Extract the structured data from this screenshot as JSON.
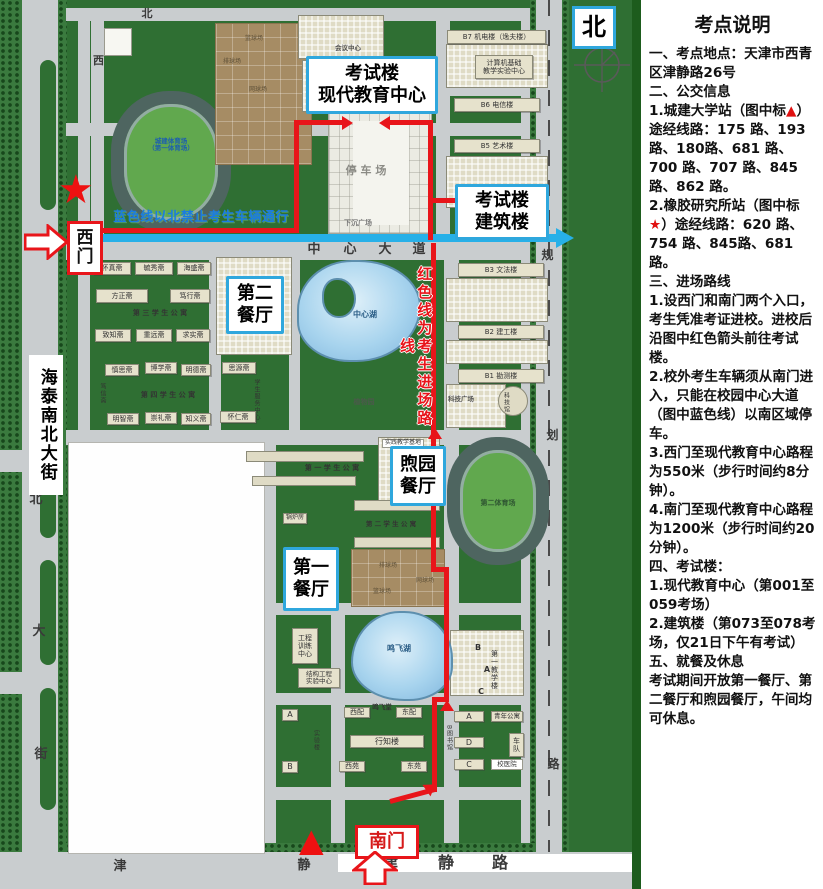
{
  "theme": {
    "marker_red": "#e01010",
    "route_red": "#e8151a",
    "route_blue": "#27b0e8",
    "callout_blue": "#2fa7dd",
    "campus_green": "#2f6f33"
  },
  "panel": {
    "title": "考点说明",
    "paragraphs": [
      [
        {
          "t": "一、考点地点：天津市西青区津静路26号"
        }
      ],
      [
        {
          "t": "二、公交信息"
        }
      ],
      [
        {
          "t": "1.城建大学站（图中标"
        },
        {
          "t": "▲",
          "c": 1
        },
        {
          "t": "）途经线路：175 路、193 路、180路、681 路、700 路、707 路、845 路、862 路。"
        }
      ],
      [
        {
          "t": "2.橡胶研究所站（图中标"
        },
        {
          "t": "★",
          "c": 1
        },
        {
          "t": "）途经线路：620 路、754 路、845路、681路。"
        }
      ],
      [
        {
          "t": "三、进场路线"
        }
      ],
      [
        {
          "t": "1.设西门和南门两个入口，考生凭准考证进校。进校后沿图中红色箭头前往考试楼。"
        }
      ],
      [
        {
          "t": "2.校外考生车辆须从南门进入，只能在校园中心大道（图中蓝色线）以南区域停车。"
        }
      ],
      [
        {
          "t": "3.西门至现代教育中心路程为550米（步行时间约8分钟）。"
        }
      ],
      [
        {
          "t": "4.南门至现代教育中心路程为1200米（步行时间约20分钟）。"
        }
      ],
      [
        {
          "t": "四、考试楼："
        }
      ],
      [
        {
          "t": "1.现代教育中心（第001至059考场）"
        }
      ],
      [
        {
          "t": "2.建筑楼（第073至078考场，"
        },
        {
          "t": "仅21日下午有考试",
          "b": 1
        },
        {
          "t": "）"
        }
      ],
      [
        {
          "t": "五、就餐及休息"
        }
      ],
      [
        {
          "t": "考试期间开放第一餐厅、第二餐厅和煦园餐厅，午间均可休息。"
        }
      ]
    ]
  },
  "map": {
    "markers": {
      "star": "★",
      "triangle": "▲"
    },
    "items": [
      {
        "id": "callout-exam-main",
        "cls": "callout",
        "lines": [
          "考试楼",
          "现代教育中心"
        ],
        "x": 306,
        "y": 56,
        "w": 126,
        "h": 52,
        "fs": 18
      },
      {
        "id": "callout-exam-arch",
        "cls": "callout",
        "lines": [
          "考试楼",
          "建筑楼"
        ],
        "x": 455,
        "y": 184,
        "w": 88,
        "h": 50,
        "fs": 18
      },
      {
        "id": "callout-canteen-2",
        "cls": "callout",
        "lines": [
          "第二",
          "餐厅"
        ],
        "x": 226,
        "y": 276,
        "w": 52,
        "h": 52,
        "fs": 18
      },
      {
        "id": "callout-canteen-xuyuan",
        "cls": "callout",
        "lines": [
          "煦园",
          "餐厅"
        ],
        "x": 390,
        "y": 446,
        "w": 50,
        "h": 54,
        "fs": 18
      },
      {
        "id": "callout-canteen-1",
        "cls": "callout",
        "lines": [
          "第一",
          "餐厅"
        ],
        "x": 283,
        "y": 547,
        "w": 50,
        "h": 58,
        "fs": 18
      },
      {
        "id": "label-west-gate",
        "cls": "gate",
        "lines": [
          "西",
          "门"
        ],
        "x": 67,
        "y": 221,
        "w": 30,
        "h": 48,
        "fs": 17
      },
      {
        "id": "label-south-gate",
        "cls": "gate",
        "t": "南门",
        "x": 355,
        "y": 825,
        "w": 58,
        "h": 28,
        "fs": 18,
        "color": "#d61a1a"
      },
      {
        "id": "label-north",
        "cls": "north",
        "t": "北",
        "x": 572,
        "y": 6,
        "w": 38,
        "h": 37,
        "fs": 24
      },
      {
        "id": "bldg-b7-jidian",
        "cls": "bar",
        "t": "B7 机电楼（逸夫楼）",
        "x": 447,
        "y": 30,
        "w": 99,
        "h": 14,
        "fs": 7
      },
      {
        "id": "bldg-computer-center",
        "cls": "bar",
        "lines": [
          "计算机基础",
          "教学实验中心"
        ],
        "x": 475,
        "y": 55,
        "w": 58,
        "h": 24,
        "fs": 7
      },
      {
        "id": "bldg-b6-dianxin",
        "cls": "bar",
        "t": "B6 电信楼",
        "x": 454,
        "y": 98,
        "w": 86,
        "h": 14,
        "fs": 7
      },
      {
        "id": "bldg-b5-yishu",
        "cls": "bar",
        "t": "B5 艺术楼",
        "x": 454,
        "y": 139,
        "w": 86,
        "h": 14,
        "fs": 7
      },
      {
        "id": "bldg-b3-wenfa",
        "cls": "bar",
        "t": "B3 文法楼",
        "x": 458,
        "y": 263,
        "w": 86,
        "h": 14,
        "fs": 7
      },
      {
        "id": "bldg-b2-jiangong",
        "cls": "bar",
        "t": "B2 建工楼",
        "x": 458,
        "y": 325,
        "w": 86,
        "h": 14,
        "fs": 7
      },
      {
        "id": "bldg-b1-kance",
        "cls": "bar",
        "t": "B1 勘测楼",
        "x": 458,
        "y": 369,
        "w": 86,
        "h": 14,
        "fs": 7
      },
      {
        "id": "label-science-plaza",
        "cls": "lbl",
        "t": "科技广场",
        "x": 444,
        "y": 395,
        "w": 34,
        "h": 9,
        "fs": 6.5,
        "color": "#555"
      },
      {
        "id": "label-science-museum",
        "cls": "vlbl",
        "t": "科技馆",
        "x": 500,
        "y": 387,
        "w": 10,
        "h": 30,
        "fs": 6
      },
      {
        "id": "dorm-huaizhen",
        "cls": "bar",
        "t": "怀真斋",
        "x": 93,
        "y": 262,
        "w": 38,
        "h": 13,
        "fs": 7
      },
      {
        "id": "dorm-yuxiu",
        "cls": "bar",
        "t": "毓秀斋",
        "x": 135,
        "y": 262,
        "w": 38,
        "h": 13,
        "fs": 7
      },
      {
        "id": "dorm-haisheng",
        "cls": "bar",
        "t": "海盛斋",
        "x": 177,
        "y": 262,
        "w": 34,
        "h": 13,
        "fs": 7
      },
      {
        "id": "dorm-fangzheng",
        "cls": "bar",
        "t": "方正斋",
        "x": 96,
        "y": 289,
        "w": 52,
        "h": 14,
        "fs": 7
      },
      {
        "id": "dorm-duxing",
        "cls": "bar",
        "t": "笃行斋",
        "x": 170,
        "y": 289,
        "w": 40,
        "h": 14,
        "fs": 7
      },
      {
        "id": "label-apartment-3",
        "cls": "lbl",
        "t": "第 三 学 生 公 寓",
        "x": 120,
        "y": 308,
        "w": 80,
        "h": 10,
        "fs": 7
      },
      {
        "id": "dorm-zhizhi",
        "cls": "bar",
        "t": "致知斋",
        "x": 95,
        "y": 329,
        "w": 36,
        "h": 13,
        "fs": 7
      },
      {
        "id": "dorm-zhongyuan",
        "cls": "bar",
        "t": "重远斋",
        "x": 136,
        "y": 329,
        "w": 36,
        "h": 13,
        "fs": 7
      },
      {
        "id": "dorm-qiushi",
        "cls": "bar",
        "t": "求实斋",
        "x": 176,
        "y": 329,
        "w": 34,
        "h": 13,
        "fs": 7
      },
      {
        "id": "dorm-shensi",
        "cls": "bar",
        "t": "慎思斋",
        "x": 105,
        "y": 364,
        "w": 34,
        "h": 12,
        "fs": 7
      },
      {
        "id": "dorm-boxue",
        "cls": "bar",
        "t": "博学斋",
        "x": 145,
        "y": 362,
        "w": 32,
        "h": 12,
        "fs": 7
      },
      {
        "id": "dorm-mingde",
        "cls": "bar",
        "t": "明德斋",
        "x": 181,
        "y": 364,
        "w": 30,
        "h": 12,
        "fs": 7
      },
      {
        "id": "dorm-siyuan",
        "cls": "bar",
        "t": "思源斋",
        "x": 222,
        "y": 362,
        "w": 34,
        "h": 12,
        "fs": 7
      },
      {
        "id": "dorm-duxin",
        "cls": "vlbl",
        "t": "笃信斋",
        "x": 96,
        "y": 378,
        "w": 11,
        "h": 30,
        "fs": 6
      },
      {
        "id": "label-apartment-4",
        "cls": "lbl",
        "t": "第 四 学 生 公 寓",
        "x": 128,
        "y": 390,
        "w": 80,
        "h": 10,
        "fs": 7
      },
      {
        "id": "label-student-service",
        "cls": "vlbl",
        "t": "学生服务中心",
        "x": 250,
        "y": 379,
        "w": 11,
        "h": 42,
        "fs": 6
      },
      {
        "id": "dorm-mingzhi",
        "cls": "bar",
        "t": "明智斋",
        "x": 107,
        "y": 413,
        "w": 32,
        "h": 12,
        "fs": 7
      },
      {
        "id": "dorm-chongli",
        "cls": "bar",
        "t": "崇礼斋",
        "x": 145,
        "y": 412,
        "w": 32,
        "h": 12,
        "fs": 7
      },
      {
        "id": "dorm-zhiyi",
        "cls": "bar",
        "t": "知义斋",
        "x": 181,
        "y": 413,
        "w": 30,
        "h": 12,
        "fs": 7
      },
      {
        "id": "dorm-huairen",
        "cls": "bar",
        "t": "怀仁斋",
        "x": 220,
        "y": 411,
        "w": 36,
        "h": 12,
        "fs": 7
      },
      {
        "id": "label-practice-base",
        "cls": "wlbl",
        "t": "实践教学基地",
        "x": 382,
        "y": 439,
        "w": 42,
        "h": 9,
        "fs": 6
      },
      {
        "id": "label-apartment-1",
        "cls": "lbl",
        "t": "第 一 学 生 公 寓",
        "x": 294,
        "y": 463,
        "w": 76,
        "h": 10,
        "fs": 7
      },
      {
        "id": "bldg-boiler",
        "cls": "bar",
        "t": "锅炉房",
        "x": 283,
        "y": 513,
        "w": 24,
        "h": 11,
        "fs": 6
      },
      {
        "id": "label-apartment-2",
        "cls": "lbl",
        "t": "第 二 学 生 公 寓",
        "x": 356,
        "y": 520,
        "w": 70,
        "h": 9,
        "fs": 6.5
      },
      {
        "id": "bldg-engineering-training",
        "cls": "bar",
        "lines": [
          "工程",
          "训练",
          "中心"
        ],
        "x": 292,
        "y": 628,
        "w": 26,
        "h": 36,
        "fs": 7
      },
      {
        "id": "bldg-structural-lab",
        "cls": "bar",
        "lines": [
          "结构工程",
          "实验中心"
        ],
        "x": 298,
        "y": 668,
        "w": 42,
        "h": 20,
        "fs": 6.5
      },
      {
        "id": "label-central-lake",
        "cls": "lbl",
        "t": "中心湖",
        "x": 350,
        "y": 310,
        "w": 30,
        "h": 10,
        "fs": 8,
        "color": "#2a5d86"
      },
      {
        "id": "label-botanical",
        "cls": "lbl",
        "t": "植物园",
        "x": 350,
        "y": 398,
        "w": 28,
        "h": 9,
        "fs": 7,
        "color": "#4a5a4a"
      },
      {
        "id": "label-mingfei-lake",
        "cls": "lbl",
        "t": "鸣飞湖",
        "x": 384,
        "y": 644,
        "w": 30,
        "h": 10,
        "fs": 8,
        "color": "#2a5d86"
      },
      {
        "id": "bldg-xipei",
        "cls": "bar",
        "t": "西配",
        "x": 344,
        "y": 707,
        "w": 26,
        "h": 11,
        "fs": 7
      },
      {
        "id": "label-mingfei-hall",
        "cls": "lbl",
        "t": "鸣飞堂",
        "x": 369,
        "y": 704,
        "w": 26,
        "h": 8,
        "fs": 6.5
      },
      {
        "id": "bldg-dongpei",
        "cls": "bar",
        "t": "东配",
        "x": 396,
        "y": 707,
        "w": 26,
        "h": 11,
        "fs": 7
      },
      {
        "id": "bldg-xingzhi",
        "cls": "bar",
        "t": "行知楼",
        "x": 350,
        "y": 735,
        "w": 74,
        "h": 13,
        "fs": 8
      },
      {
        "id": "bldg-xiyuan",
        "cls": "bar",
        "t": "西苑",
        "x": 339,
        "y": 761,
        "w": 26,
        "h": 11,
        "fs": 7
      },
      {
        "id": "bldg-dongyuan",
        "cls": "bar",
        "t": "东苑",
        "x": 401,
        "y": 761,
        "w": 26,
        "h": 11,
        "fs": 7
      },
      {
        "id": "bldg-block-a-west",
        "cls": "bar",
        "t": "A",
        "x": 282,
        "y": 709,
        "w": 16,
        "h": 12,
        "fs": 8
      },
      {
        "id": "bldg-block-b-west",
        "cls": "bar",
        "t": "B",
        "x": 282,
        "y": 761,
        "w": 16,
        "h": 12,
        "fs": 8
      },
      {
        "id": "label-lab-building",
        "cls": "vlbl",
        "t": "实验楼",
        "x": 310,
        "y": 726,
        "w": 10,
        "h": 28,
        "fs": 6
      },
      {
        "id": "label-first-teaching",
        "cls": "vlbl",
        "t": "第一教学楼",
        "x": 489,
        "y": 648,
        "w": 11,
        "h": 44,
        "fs": 7
      },
      {
        "id": "label-t1-b",
        "cls": "lbl",
        "t": "B",
        "x": 472,
        "y": 643,
        "w": 12,
        "h": 9,
        "fs": 8
      },
      {
        "id": "label-t1-a",
        "cls": "lbl",
        "t": "A",
        "x": 481,
        "y": 665,
        "w": 12,
        "h": 9,
        "fs": 8
      },
      {
        "id": "label-t1-c",
        "cls": "lbl",
        "t": "C",
        "x": 475,
        "y": 687,
        "w": 12,
        "h": 9,
        "fs": 8
      },
      {
        "id": "bldg-lib-a",
        "cls": "bar",
        "t": "A",
        "x": 454,
        "y": 711,
        "w": 30,
        "h": 11,
        "fs": 8
      },
      {
        "id": "bldg-lib-d",
        "cls": "bar",
        "t": "D",
        "x": 454,
        "y": 737,
        "w": 30,
        "h": 11,
        "fs": 8
      },
      {
        "id": "bldg-lib-c",
        "cls": "bar",
        "t": "C",
        "x": 454,
        "y": 759,
        "w": 30,
        "h": 11,
        "fs": 8
      },
      {
        "id": "label-library",
        "cls": "vlbl",
        "t": "B图书馆",
        "x": 443,
        "y": 718,
        "w": 10,
        "h": 40,
        "fs": 6
      },
      {
        "id": "bldg-youth-apartment",
        "cls": "bar",
        "t": "青年公寓",
        "x": 491,
        "y": 711,
        "w": 32,
        "h": 11,
        "fs": 6.5
      },
      {
        "id": "bldg-motorpool",
        "cls": "bar",
        "lines": [
          "车",
          "队"
        ],
        "x": 509,
        "y": 733,
        "w": 15,
        "h": 24,
        "fs": 7
      },
      {
        "id": "bldg-hospital",
        "cls": "wlbl",
        "t": "校医院",
        "x": 491,
        "y": 759,
        "w": 32,
        "h": 11,
        "fs": 6.5
      },
      {
        "id": "label-stadium-1",
        "cls": "lbl",
        "lines": [
          "城建体育场",
          "（第一体育场）"
        ],
        "x": 136,
        "y": 136,
        "w": 70,
        "h": 18,
        "fs": 6.5,
        "color": "#1d5fae"
      },
      {
        "id": "label-stadium-2",
        "cls": "lbl",
        "t": "第二体育场",
        "x": 462,
        "y": 498,
        "w": 72,
        "h": 10,
        "fs": 7,
        "color": "#2e5531"
      },
      {
        "id": "label-court-basketball-n",
        "cls": "court-lbl",
        "t": "篮球场",
        "x": 242,
        "y": 35,
        "w": 24,
        "h": 8,
        "fs": 6
      },
      {
        "id": "label-court-volleyball-n",
        "cls": "court-lbl",
        "t": "排球场",
        "x": 220,
        "y": 58,
        "w": 24,
        "h": 8,
        "fs": 6
      },
      {
        "id": "label-court-tennis-n",
        "cls": "court-lbl",
        "t": "网球场",
        "x": 246,
        "y": 86,
        "w": 24,
        "h": 8,
        "fs": 6
      },
      {
        "id": "label-court-volleyball-s",
        "cls": "court-lbl",
        "t": "排球场",
        "x": 376,
        "y": 562,
        "w": 24,
        "h": 8,
        "fs": 6
      },
      {
        "id": "label-court-tennis-s",
        "cls": "court-lbl",
        "t": "网球场",
        "x": 413,
        "y": 577,
        "w": 24,
        "h": 8,
        "fs": 6
      },
      {
        "id": "label-court-basketball-s",
        "cls": "court-lbl",
        "t": "篮球场",
        "x": 370,
        "y": 588,
        "w": 24,
        "h": 8,
        "fs": 6
      },
      {
        "id": "label-conference-center",
        "cls": "lbl",
        "t": "会议中心",
        "x": 330,
        "y": 44,
        "w": 36,
        "h": 9,
        "fs": 6.5,
        "color": "#555"
      },
      {
        "id": "label-parking",
        "cls": "lbl",
        "t": "停 车 场",
        "x": 342,
        "y": 164,
        "w": 48,
        "h": 14,
        "fs": 11,
        "color": "#8b8b85"
      },
      {
        "id": "label-sunken-plaza",
        "cls": "lbl",
        "t": "下沉广场",
        "x": 338,
        "y": 219,
        "w": 40,
        "h": 9,
        "fs": 7,
        "color": "#777"
      },
      {
        "id": "street-label-haitai",
        "cls": "vstreet",
        "t": "海泰南北大街",
        "x": 29,
        "y": 355,
        "w": 34,
        "h": 140,
        "fs": 17
      },
      {
        "id": "char-street-bei",
        "cls": "rchar",
        "t": "北",
        "x": 28,
        "y": 492,
        "w": 16,
        "h": 16,
        "fs": 13
      },
      {
        "id": "char-street-da",
        "cls": "rchar",
        "t": "大",
        "x": 31,
        "y": 624,
        "w": 16,
        "h": 16,
        "fs": 13
      },
      {
        "id": "char-street-jie",
        "cls": "rchar",
        "t": "街",
        "x": 33,
        "y": 747,
        "w": 16,
        "h": 16,
        "fs": 13
      },
      {
        "id": "char-north-road",
        "cls": "rchar",
        "t": "北",
        "x": 140,
        "y": 8,
        "w": 14,
        "h": 13,
        "fs": 11
      },
      {
        "id": "char-west-road",
        "cls": "rchar",
        "t": "西",
        "x": 92,
        "y": 55,
        "w": 13,
        "h": 13,
        "fs": 11
      },
      {
        "id": "char-avenue-zhong",
        "cls": "rchar xb",
        "t": "中",
        "x": 306,
        "y": 243,
        "w": 16,
        "h": 15,
        "fs": 13
      },
      {
        "id": "char-avenue-xin",
        "cls": "rchar xb",
        "t": "心",
        "x": 342,
        "y": 243,
        "w": 16,
        "h": 15,
        "fs": 13
      },
      {
        "id": "char-avenue-da",
        "cls": "rchar xb",
        "t": "大",
        "x": 377,
        "y": 243,
        "w": 16,
        "h": 15,
        "fs": 13
      },
      {
        "id": "char-avenue-dao",
        "cls": "rchar xb",
        "t": "道",
        "x": 411,
        "y": 243,
        "w": 16,
        "h": 15,
        "fs": 13
      },
      {
        "id": "char-east-road-gui",
        "cls": "rchar",
        "t": "规",
        "x": 540,
        "y": 248,
        "w": 15,
        "h": 15,
        "fs": 12
      },
      {
        "id": "char-east-road-hua",
        "cls": "rchar",
        "t": "划",
        "x": 545,
        "y": 428,
        "w": 15,
        "h": 15,
        "fs": 12
      },
      {
        "id": "char-east-road-lu",
        "cls": "rchar",
        "t": "路",
        "x": 546,
        "y": 757,
        "w": 15,
        "h": 15,
        "fs": 12
      },
      {
        "id": "char-south-road-jin",
        "cls": "rchar",
        "t": "津",
        "x": 112,
        "y": 860,
        "w": 16,
        "h": 15,
        "fs": 13
      },
      {
        "id": "char-south-road-jing",
        "cls": "rchar",
        "t": "静",
        "x": 296,
        "y": 859,
        "w": 16,
        "h": 15,
        "fs": 13
      },
      {
        "id": "char-jinjing-jin",
        "cls": "rchar xb",
        "t": "津",
        "x": 380,
        "y": 855,
        "w": 20,
        "h": 17,
        "fs": 16
      },
      {
        "id": "char-jinjing-jing",
        "cls": "rchar xb",
        "t": "静",
        "x": 436,
        "y": 855,
        "w": 20,
        "h": 17,
        "fs": 16
      },
      {
        "id": "char-jinjing-lu",
        "cls": "rchar xb",
        "t": "路",
        "x": 490,
        "y": 855,
        "w": 20,
        "h": 17,
        "fs": 16
      },
      {
        "id": "label-blue-note",
        "cls": "bluenote",
        "t": "蓝色线以北禁止考生车辆通行",
        "x": 103,
        "y": 210,
        "w": 196,
        "h": 16,
        "fs": 13
      },
      {
        "id": "label-red-note",
        "cls": "rednote",
        "t": "红色线为考生进场路线",
        "x": 404,
        "y": 258,
        "w": 22,
        "h": 178,
        "fs": 15
      }
    ]
  }
}
